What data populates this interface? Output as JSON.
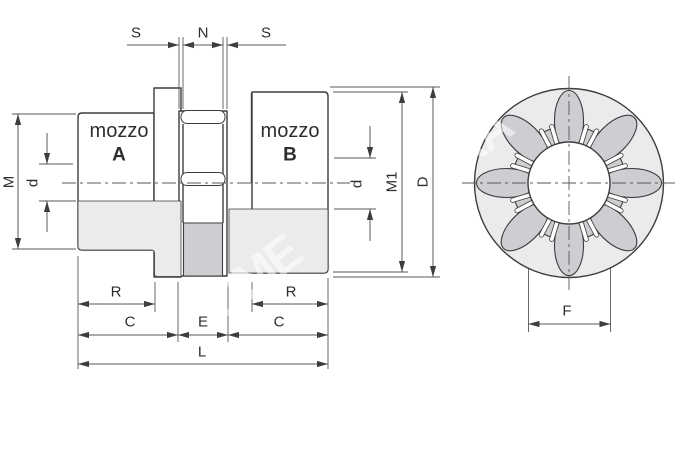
{
  "drawing": {
    "type": "technical-drawing-jaw-coupling",
    "section_view": {
      "hub_a": {
        "word": "mozzo",
        "letter": "A"
      },
      "hub_b": {
        "word": "mozzo",
        "letter": "B"
      },
      "dims": {
        "gap_left": "S",
        "center_gap": "N",
        "gap_right": "S",
        "hub_a_od": "M",
        "bore_a": "d",
        "bore_b": "d",
        "hub_b_od": "M1",
        "flange_od": "D",
        "hub_a_body_len": "R",
        "hub_b_body_len": "R",
        "hub_a_len": "C",
        "spider_width": "E",
        "hub_b_len": "C",
        "total_len": "L"
      }
    },
    "front_view": {
      "dims": {
        "spider_bore": "F"
      }
    },
    "watermark": {
      "segment_1": "OME",
      "segment_2": "RA"
    },
    "colors": {
      "line": "#3d3d3d",
      "dim-line": "#585858",
      "gray-light": "#ebebed",
      "gray-mid": "#cdced1",
      "text": "#2e2e2e"
    }
  }
}
